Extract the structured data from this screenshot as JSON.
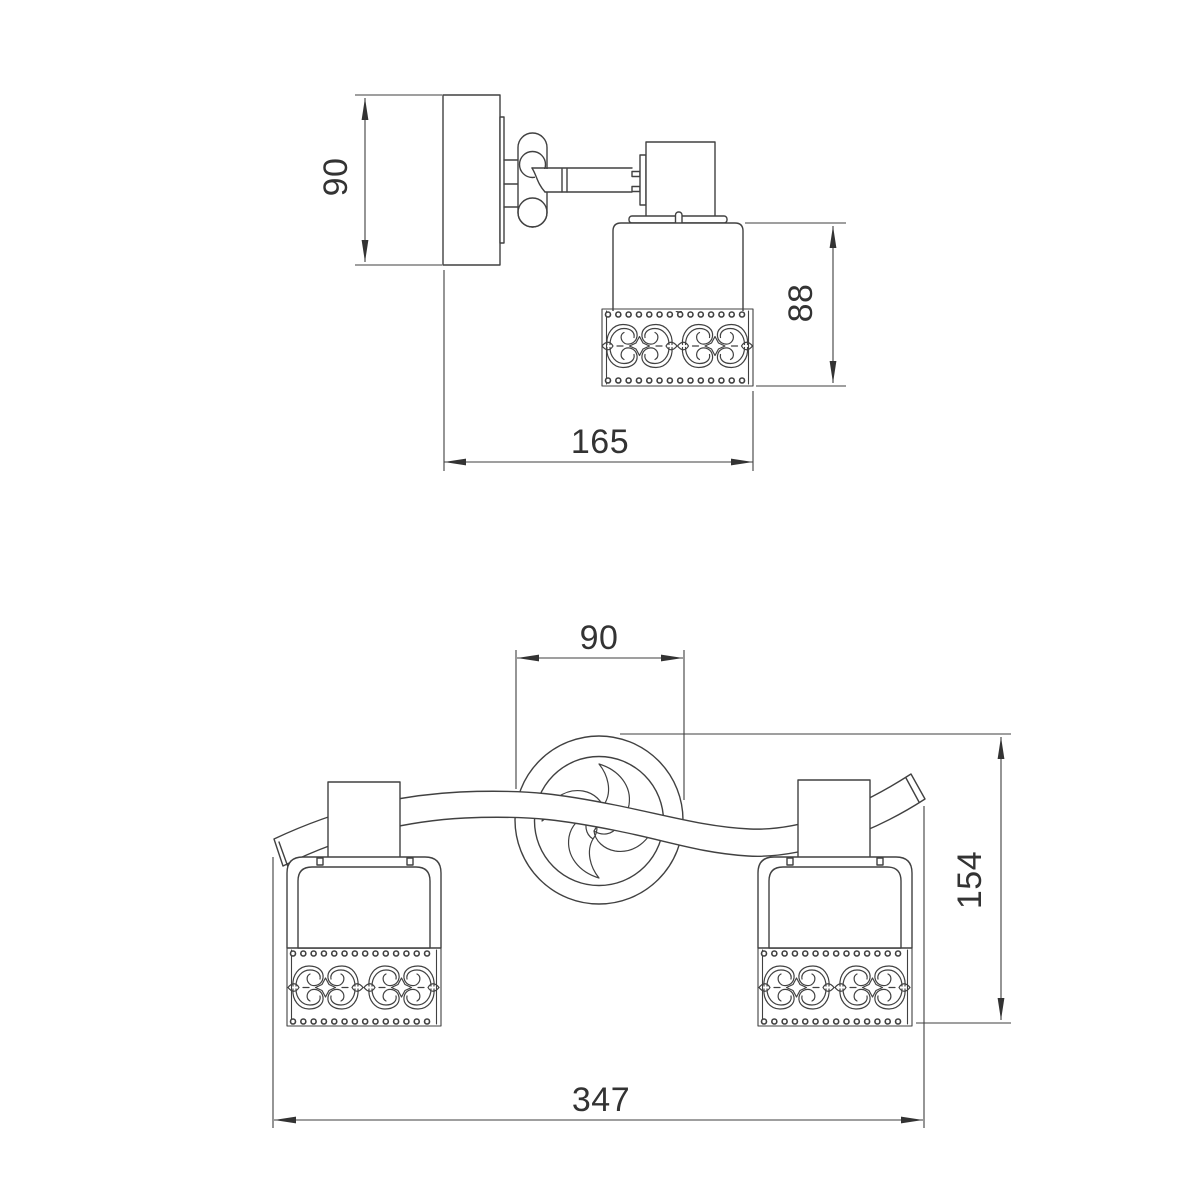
{
  "drawing": {
    "type": "technical-dimension-drawing",
    "subject": "wall-spot-light-fixture",
    "colors": {
      "line": "#414141",
      "text": "#333333",
      "background": "#ffffff"
    },
    "views": {
      "side": {
        "dims": {
          "plate_height": "90",
          "shade_height": "88",
          "depth": "165"
        }
      },
      "front": {
        "dims": {
          "canopy_diameter": "90",
          "total_height": "154",
          "total_width": "347"
        }
      }
    }
  }
}
